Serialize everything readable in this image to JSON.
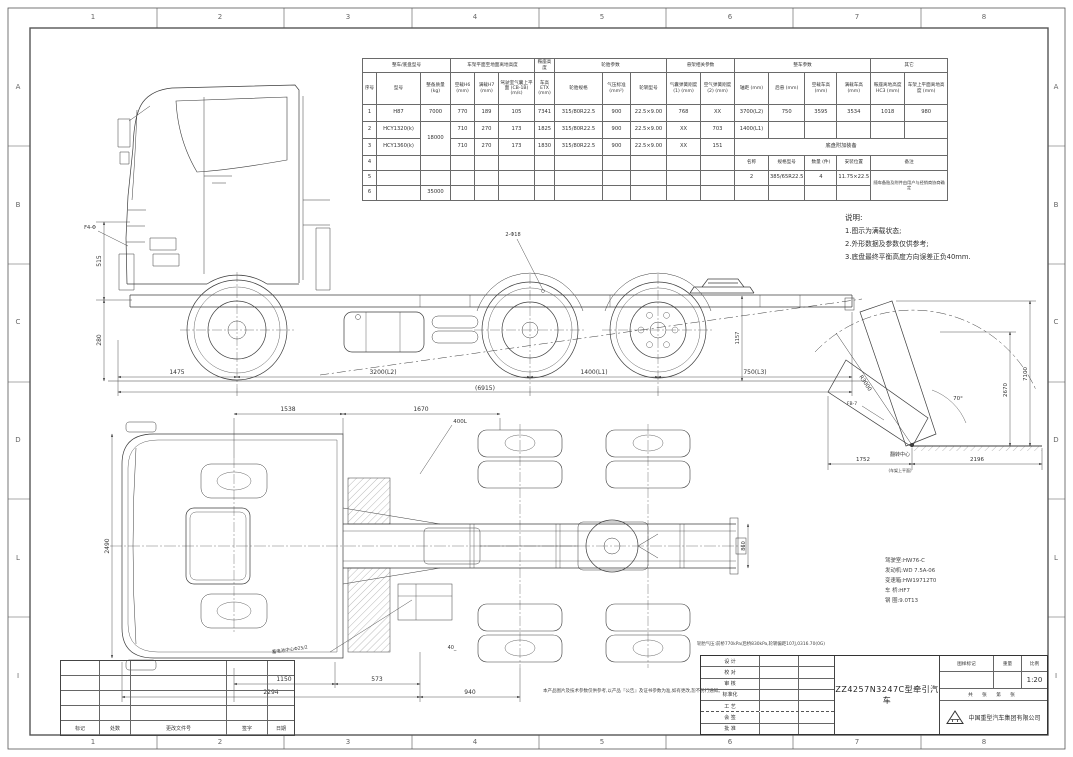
{
  "sheet": {
    "grid_cols": [
      "1",
      "2",
      "3",
      "4",
      "5",
      "6",
      "7",
      "8"
    ],
    "grid_rows": [
      "A",
      "B",
      "C",
      "D",
      "L",
      "I"
    ]
  },
  "spec_table": {
    "groups": [
      "整车/底盘型号",
      "车架平面至地面离地高度",
      "鞍座高度",
      "轮胎参数",
      "悬架相关参数",
      "整车参数",
      "其它"
    ],
    "headers": [
      "序号",
      "型号",
      "整备质量 (kg)",
      "空载H6 (mm)",
      "满载H7 (mm)",
      "驾驶室气囊上平面 (CB-1B) (m/s)",
      "车高 ETX (mm)",
      "轮胎规格",
      "气压标准 (mm²)",
      "轮辋型号",
      "气囊弹簧刚度(1) (mm)",
      "空气弹簧刚度(2) (mm)",
      "轴距 (mm)",
      "后悬 (mm)",
      "空载车高 (mm)",
      "满载车高 (mm)",
      "鞍座离地高度 HC3 (mm)",
      "车架上平面离地高度 (mm)"
    ],
    "rows": [
      [
        "1",
        "H87",
        "7000",
        "770",
        "189",
        "105",
        "7341",
        "315/80R22.5",
        "900",
        "22.5×9.00",
        "768",
        "XX",
        "3700(L2)",
        "750",
        "3595",
        "3534",
        "1018",
        "980"
      ],
      [
        "2",
        "HCY1320(k)",
        "18000",
        "710",
        "270",
        "173",
        "1825",
        "315/80R22.5",
        "900",
        "22.5×9.00",
        "XX",
        "703",
        "1400(L1)",
        "",
        "",
        "",
        "",
        ""
      ],
      [
        "3",
        "HCY1360(k)",
        "710",
        "270",
        "173",
        "1830",
        "315/80R22.5",
        "900",
        "22.5×9.00",
        "XX",
        "151",
        "底盘附加装备"
      ],
      [
        "4",
        "",
        "",
        "",
        "",
        "",
        "",
        "",
        "",
        "",
        "",
        "",
        "名称",
        "规格型号",
        "数量 (件)",
        "安装位置",
        "备注"
      ],
      [
        "5",
        "",
        "",
        "",
        "",
        "",
        "",
        "",
        "",
        "",
        "",
        "",
        "2",
        "385/65R22.5",
        "4",
        "11.75×22.5",
        "随车备胎及附件由用户与经销商协商确定"
      ],
      [
        "6",
        "",
        "35000",
        "",
        "",
        "",
        "",
        "",
        "",
        "",
        "",
        "",
        "",
        "",
        "",
        ""
      ]
    ]
  },
  "notes": {
    "title": "说明:",
    "items": [
      "1.图示为满载状态;",
      "2.外形数据及参数仅供参考;",
      "3.底盘最终平衡高度方向误差正负40mm."
    ]
  },
  "side_view": {
    "d_front": "1475",
    "d_wb": "3200(L2)",
    "d_tandem": "1400(L1)",
    "d_rear": "750(L3)",
    "d_total": "(6915)",
    "v1": "515",
    "v2": "280",
    "v3": "1157",
    "leader1": "F4-Φ",
    "leader2": "2-Φ18"
  },
  "top_view": {
    "d1": "1538",
    "d2": "1670",
    "d3": "400L",
    "d4": "1150",
    "d5": "573",
    "d6": "2294",
    "d7": "940",
    "v_left": "2490",
    "v_right": "860",
    "battery_label": "蓄电池中心Φ25/2",
    "step_label": "40_"
  },
  "tilt_view": {
    "radius": "R3000",
    "angle": "70°",
    "v1": "2670",
    "v2": "7100",
    "b1": "1752",
    "b2": "2196",
    "pivot": "翻转中心",
    "pivot_sub": "(车架上平面)",
    "fb": "FB-7"
  },
  "config": {
    "lines": [
      "驾驶室:HW76-C",
      "发动机:WD 7.5A-06",
      "变速箱:HW19712T0",
      "车 桥:HF7",
      "钢 圈:9.0T13"
    ],
    "footnote": "轮胎气压:前桥770kPa/后桥830kPa,轮辋偏距107J,0316.70(0G)"
  },
  "bottom_note": "本产品图片及技术参数仅供参考,以产品『公告』及证书参数为准,如有更改,恕不另行通知。",
  "title_block": {
    "sign_rows": [
      "设 计",
      "校 对",
      "审 核",
      "标准化",
      "工 艺",
      "会 签",
      "批 准"
    ],
    "title": "ZZ4257N3247C型牵引汽车",
    "mark_label": "图样标记",
    "weight_label": "重量",
    "scale_label": "比例",
    "scale": "1:20",
    "sheets": "共 张 第 张",
    "company": "中国重型汽车集团有限公司"
  },
  "revision": {
    "cols": [
      "标记",
      "处数",
      "更改文件号",
      "签字",
      "日期"
    ]
  }
}
